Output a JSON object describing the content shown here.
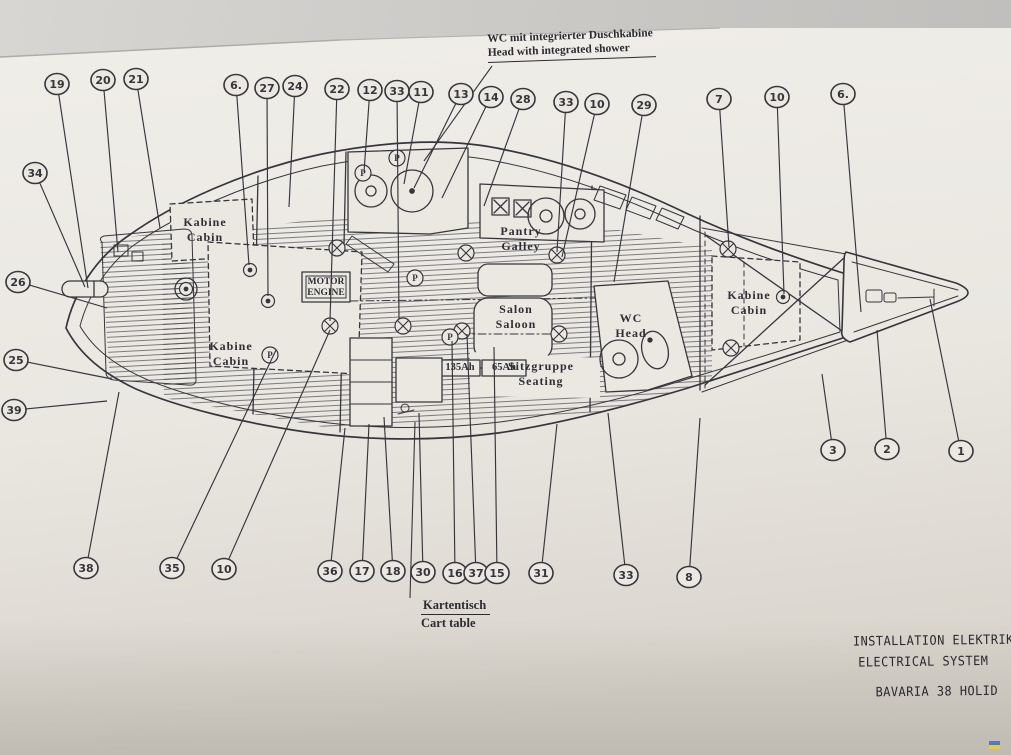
{
  "photo": {
    "paper_color": "#ebe8e2",
    "ink_color": "#35353c",
    "background_color": "#c9c7c4"
  },
  "annotations": {
    "top_note": {
      "line1": "WC mit integrierter Duschkabine",
      "line2": "Head with integrated shower"
    },
    "chart_table_note": {
      "line1": "Kartentisch",
      "line2": "Cart table"
    }
  },
  "title_block": {
    "line1": "INSTALLATION  ELEKTRIK",
    "line2": "ELECTRICAL  SYSTEM",
    "line3": "BAVARIA  38  HOLID"
  },
  "engine_label": {
    "line1": "MOTOR",
    "line2": "ENGINE"
  },
  "batteries": {
    "b1": "135Ah",
    "b2": "65Ah"
  },
  "rooms": [
    {
      "id": "fwd-cabin-port",
      "line1": "Kabine",
      "line2": "Cabin",
      "x": 205,
      "y": 215
    },
    {
      "id": "fwd-cabin-stbd",
      "line1": "Kabine",
      "line2": "Cabin",
      "x": 231,
      "y": 339
    },
    {
      "id": "galley",
      "line1": "Pantry",
      "line2": "Galley",
      "x": 521,
      "y": 224
    },
    {
      "id": "saloon",
      "line1": "Salon",
      "line2": "Saloon",
      "x": 516,
      "y": 302
    },
    {
      "id": "head",
      "line1": "WC",
      "line2": "Head",
      "x": 631,
      "y": 311
    },
    {
      "id": "seating",
      "line1": "Sitzgruppe",
      "line2": "Seating",
      "x": 541,
      "y": 359
    },
    {
      "id": "aft-cabin",
      "line1": "Kabine",
      "line2": "Cabin",
      "x": 749,
      "y": 288
    }
  ],
  "callouts": [
    {
      "n": "19",
      "x": 57,
      "y": 84,
      "tx": 88,
      "ty": 288
    },
    {
      "n": "20",
      "x": 103,
      "y": 80,
      "tx": 118,
      "ty": 252
    },
    {
      "n": "21",
      "x": 136,
      "y": 79,
      "tx": 160,
      "ty": 228
    },
    {
      "n": "6.",
      "x": 236,
      "y": 85,
      "tx": 249,
      "ty": 265
    },
    {
      "n": "27",
      "x": 267,
      "y": 88,
      "tx": 268,
      "ty": 296
    },
    {
      "n": "24",
      "x": 295,
      "y": 86,
      "tx": 289,
      "ty": 207
    },
    {
      "n": "22",
      "x": 337,
      "y": 89,
      "tx": 330,
      "ty": 321
    },
    {
      "n": "12",
      "x": 370,
      "y": 90,
      "tx": 364,
      "ty": 172
    },
    {
      "n": "33",
      "x": 397,
      "y": 91,
      "tx": 399,
      "ty": 319
    },
    {
      "n": "11",
      "x": 421,
      "y": 92,
      "tx": 404,
      "ty": 184
    },
    {
      "n": "13",
      "x": 461,
      "y": 94,
      "tx": 414,
      "ty": 188
    },
    {
      "n": "14",
      "x": 491,
      "y": 97,
      "tx": 442,
      "ty": 198
    },
    {
      "n": "28",
      "x": 523,
      "y": 99,
      "tx": 484,
      "ty": 206
    },
    {
      "n": "33",
      "x": 566,
      "y": 102,
      "tx": 557,
      "ty": 252
    },
    {
      "n": "10",
      "x": 597,
      "y": 104,
      "tx": 562,
      "ty": 257
    },
    {
      "n": "29",
      "x": 644,
      "y": 105,
      "tx": 614,
      "ty": 282
    },
    {
      "n": "7",
      "x": 719,
      "y": 99,
      "tx": 729,
      "ty": 247
    },
    {
      "n": "10",
      "x": 777,
      "y": 97,
      "tx": 784,
      "ty": 294
    },
    {
      "n": "6.",
      "x": 843,
      "y": 94,
      "tx": 861,
      "ty": 312
    },
    {
      "n": "34",
      "x": 35,
      "y": 173,
      "tx": 85,
      "ty": 287
    },
    {
      "n": "26",
      "x": 18,
      "y": 282,
      "tx": 107,
      "ty": 308
    },
    {
      "n": "25",
      "x": 16,
      "y": 360,
      "tx": 112,
      "ty": 379
    },
    {
      "n": "39",
      "x": 14,
      "y": 410,
      "tx": 107,
      "ty": 401
    },
    {
      "n": "38",
      "x": 86,
      "y": 568,
      "tx": 119,
      "ty": 392
    },
    {
      "n": "35",
      "x": 172,
      "y": 568,
      "tx": 276,
      "ty": 350
    },
    {
      "n": "10",
      "x": 224,
      "y": 569,
      "tx": 330,
      "ty": 330
    },
    {
      "n": "36",
      "x": 330,
      "y": 571,
      "tx": 345,
      "ty": 428
    },
    {
      "n": "17",
      "x": 362,
      "y": 571,
      "tx": 369,
      "ty": 424
    },
    {
      "n": "18",
      "x": 393,
      "y": 571,
      "tx": 384,
      "ty": 417
    },
    {
      "n": "30",
      "x": 423,
      "y": 572,
      "tx": 419,
      "ty": 413
    },
    {
      "n": "16",
      "x": 455,
      "y": 573,
      "tx": 452,
      "ty": 341
    },
    {
      "n": "37",
      "x": 476,
      "y": 573,
      "tx": 467,
      "ty": 334
    },
    {
      "n": "15",
      "x": 497,
      "y": 573,
      "tx": 494,
      "ty": 347
    },
    {
      "n": "31",
      "x": 541,
      "y": 573,
      "tx": 557,
      "ty": 424
    },
    {
      "n": "33",
      "x": 626,
      "y": 575,
      "tx": 608,
      "ty": 413
    },
    {
      "n": "8",
      "x": 689,
      "y": 577,
      "tx": 700,
      "ty": 418
    },
    {
      "n": "3",
      "x": 833,
      "y": 450,
      "tx": 822,
      "ty": 374
    },
    {
      "n": "2",
      "x": 887,
      "y": 449,
      "tx": 877,
      "ty": 330
    },
    {
      "n": "1",
      "x": 961,
      "y": 451,
      "tx": 930,
      "ty": 299
    }
  ],
  "symbols": {
    "lamps": [
      [
        337,
        248
      ],
      [
        330,
        326
      ],
      [
        403,
        326
      ],
      [
        466,
        253
      ],
      [
        557,
        255
      ],
      [
        462,
        331
      ],
      [
        559,
        334
      ],
      [
        728,
        249
      ],
      [
        731,
        348
      ]
    ],
    "spots": [
      [
        250,
        270
      ],
      [
        268,
        301
      ],
      [
        783,
        297
      ],
      [
        186,
        289
      ]
    ],
    "pumps": [
      [
        397,
        158
      ],
      [
        363,
        173
      ],
      [
        415,
        278
      ],
      [
        450,
        337
      ],
      [
        270,
        355
      ]
    ]
  }
}
